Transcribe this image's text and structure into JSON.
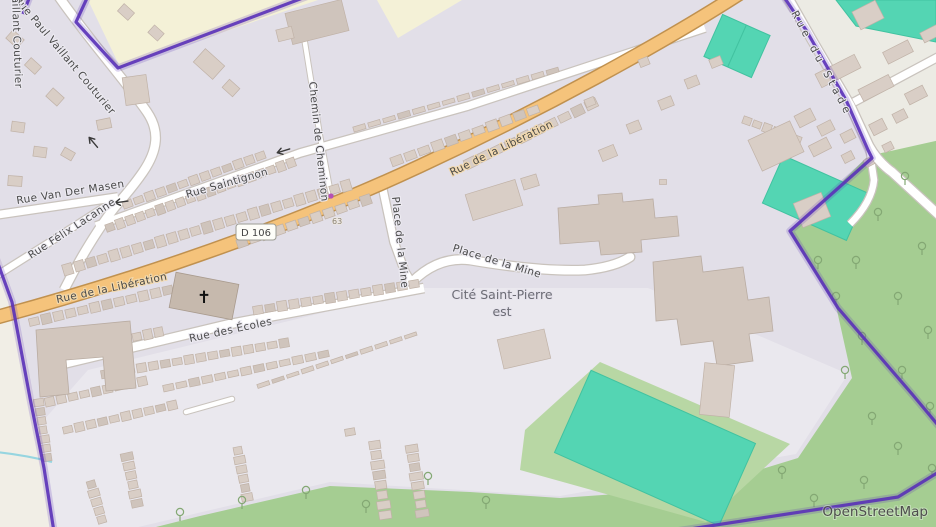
{
  "attribution": "OpenStreetMap",
  "road_ref_badge": "D 106",
  "house_number": "63",
  "place_labels": {
    "cite_line1": "Cité Saint-Pierre",
    "cite_line2": "est"
  },
  "street_names": {
    "paul_vaillant_couturier": "Rue Paul Vaillant Couturier",
    "van_der_masen": "Rue Van Der Masen",
    "felix_lacanne": "Rue Félix Lacanne",
    "saintignon": "Rue Saintignon",
    "chemin_cheminon": "Chemin de Cheminon",
    "liberation": "Rue de la Libération",
    "place_mine": "Place de la Mine",
    "ecoles": "Rue des Écoles",
    "stade": "Rue du Stade"
  },
  "icons": {
    "church_cross": "✝",
    "oneway_arrow": "left-arrow",
    "tree": "broadleaf-tree"
  },
  "colors": {
    "residential": "#e2dfe8",
    "paved_area": "#eae8ee",
    "farmland_west": "#f1eee6",
    "farmland_yellow": "#f4f1d7",
    "forest": "#a5cd92",
    "grass": "#b8d7a4",
    "pitch_teal": "#54d5b3",
    "road_fill": "#ffffff",
    "road_casing": "#c9c3bd",
    "secondary_fill": "#f5c37b",
    "secondary_casing": "#c0914f",
    "boundary_purple": "#5a31b8",
    "building": "#d9cec6",
    "building_outline": "#c0b2a7",
    "church_building": "#c6b9ad",
    "stream": "#96d5e0",
    "poi_dot": "#b650b6"
  }
}
